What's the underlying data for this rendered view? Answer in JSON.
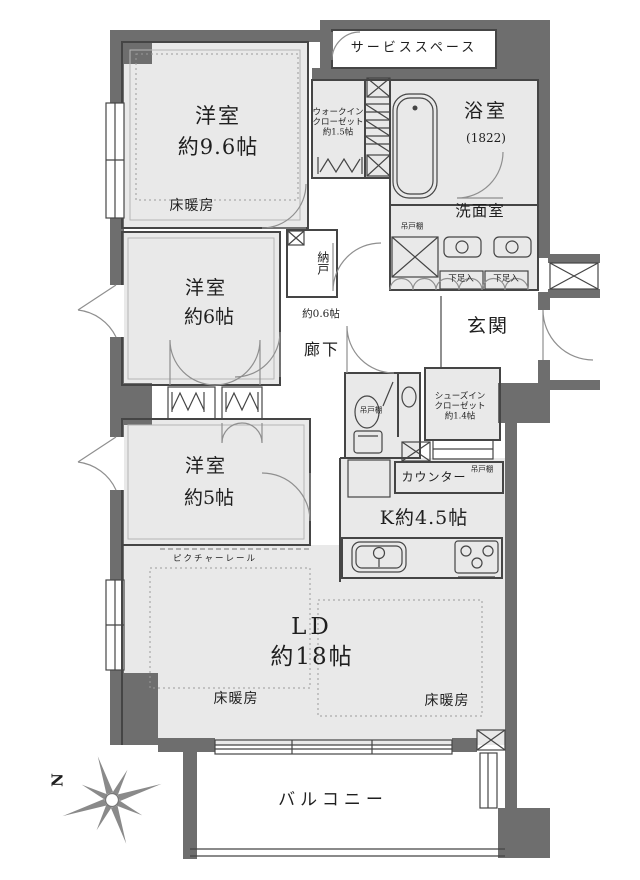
{
  "colors": {
    "wall": "#6e6e6e",
    "room_fill": "#e9e9e9",
    "outline": "#454545",
    "door_arc": "#8f8f8f",
    "background": "#ffffff",
    "text": "#1f1f1f"
  },
  "compass": {
    "north_label": "N"
  },
  "rooms": {
    "service_space": {
      "label": "サービススペース"
    },
    "bedroom_main": {
      "name": "洋室",
      "size": "約9.6帖",
      "floor_heating": "床暖房"
    },
    "walk_in_closet": {
      "line1": "ウォークイン",
      "line2": "クローゼット",
      "line3": "約1.5帖"
    },
    "bathroom": {
      "name": "浴室",
      "size": "(1822)"
    },
    "washroom": {
      "name": "洗面室",
      "hanging_cupboard": "吊戸棚"
    },
    "entrance": {
      "name": "玄関",
      "shoe_box_left": "下足入",
      "shoe_box_right": "下足入"
    },
    "storage": {
      "name": "納戸",
      "size": "約0.6帖"
    },
    "hallway": {
      "name": "廊下"
    },
    "bedroom_mid": {
      "name": "洋室",
      "size": "約6帖"
    },
    "bedroom_small": {
      "name": "洋室",
      "size": "約5帖"
    },
    "toilet": {
      "hanging_cupboard": "吊戸棚"
    },
    "shoes_in_closet": {
      "line1": "シューズイン",
      "line2": "クローゼット",
      "line3": "約1.4帖"
    },
    "counter": {
      "name": "カウンター",
      "hanging_cupboard": "吊戸棚"
    },
    "kitchen": {
      "name": "K約4.5帖"
    },
    "living_dining": {
      "name": "LD",
      "size": "約18帖",
      "floor_heating_left": "床暖房",
      "floor_heating_right": "床暖房",
      "picture_rail": "ピクチャーレール"
    },
    "balcony": {
      "name": "バルコニー"
    }
  }
}
